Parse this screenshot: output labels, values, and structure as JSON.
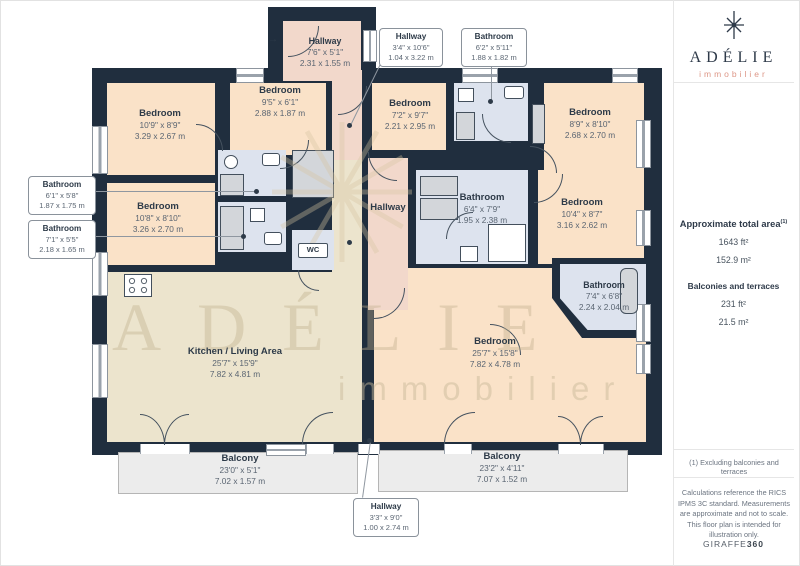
{
  "plan": {
    "watermark": {
      "line1": "ADÉLIE",
      "line2": "immobilier"
    },
    "entry_arrow": "→",
    "hallway_center_label": "Hallway",
    "wc_label": "WC",
    "rooms": [
      {
        "name": "Hallway",
        "dims_ft": "7'6\" x 5'1\"",
        "dims_m": "2.31 x 1.55 m"
      },
      {
        "name": "Bedroom",
        "dims_ft": "10'9\" x 8'9\"",
        "dims_m": "3.29 x 2.67 m"
      },
      {
        "name": "Bedroom",
        "dims_ft": "9'5\" x 6'1\"",
        "dims_m": "2.88 x 1.87 m"
      },
      {
        "name": "Bedroom",
        "dims_ft": "10'8\" x 8'10\"",
        "dims_m": "3.26 x 2.70 m"
      },
      {
        "name": "Kitchen / Living Area",
        "dims_ft": "25'7\" x 15'9\"",
        "dims_m": "7.82 x 4.81 m"
      },
      {
        "name": "Bedroom",
        "dims_ft": "7'2\" x 9'7\"",
        "dims_m": "2.21 x 2.95 m"
      },
      {
        "name": "Bedroom",
        "dims_ft": "8'9\" x 8'10\"",
        "dims_m": "2.68 x 2.70 m"
      },
      {
        "name": "Bathroom",
        "dims_ft": "6'4\" x 7'9\"",
        "dims_m": "1.95 x 2.38 m"
      },
      {
        "name": "Bedroom",
        "dims_ft": "10'4\" x 8'7\"",
        "dims_m": "3.16 x 2.62 m"
      },
      {
        "name": "Bathroom",
        "dims_ft": "7'4\" x 6'8\"",
        "dims_m": "2.24 x 2.04 m"
      },
      {
        "name": "Bedroom",
        "dims_ft": "25'7\" x 15'8\"",
        "dims_m": "7.82 x 4.78 m"
      },
      {
        "name": "Balcony",
        "dims_ft": "23'0\" x 5'1\"",
        "dims_m": "7.02 x 1.57 m"
      },
      {
        "name": "Balcony",
        "dims_ft": "23'2\" x 4'11\"",
        "dims_m": "7.07 x 1.52 m"
      }
    ],
    "callouts": [
      {
        "name": "Bathroom",
        "dims_ft": "6'1\" x 5'8\"",
        "dims_m": "1.87 x 1.75 m"
      },
      {
        "name": "Bathroom",
        "dims_ft": "7'1\" x 5'5\"",
        "dims_m": "2.18 x 1.65 m"
      },
      {
        "name": "Hallway",
        "dims_ft": "3'4\" x 10'6\"",
        "dims_m": "1.04 x 3.22 m"
      },
      {
        "name": "Bathroom",
        "dims_ft": "6'2\" x 5'11\"",
        "dims_m": "1.88 x 1.82 m"
      },
      {
        "name": "Hallway",
        "dims_ft": "3'3\" x 9'0\"",
        "dims_m": "1.00 x 2.74 m"
      }
    ]
  },
  "sidebar": {
    "brand": {
      "name": "ADÉLIE",
      "tagline": "immobilier"
    },
    "area": {
      "title": "Approximate total area",
      "sup": "(1)",
      "ft": "1643 ft²",
      "m": "152.9 m²"
    },
    "balconies": {
      "title": "Balconies and terraces",
      "ft": "231 ft²",
      "m": "21.5 m²"
    },
    "footnote": "(1) Excluding balconies and terraces",
    "disclaimer": "Calculations reference the RICS IPMS 3C standard. Measurements are approximate and not to scale. This floor plan is intended for illustration only.",
    "credit": {
      "brand": "GIRAFFE",
      "suffix": "360"
    }
  },
  "colors": {
    "wall": "#202e3e",
    "bedroom": "#fae2c8",
    "hallway": "#f2d8cb",
    "bathroom": "#dde3ee",
    "kitchen_living": "#ece4cd",
    "balcony": "#ececec",
    "brand_navy": "#2e3a49",
    "brand_salmon": "#dd9787",
    "label_text": "#2d3a48"
  }
}
